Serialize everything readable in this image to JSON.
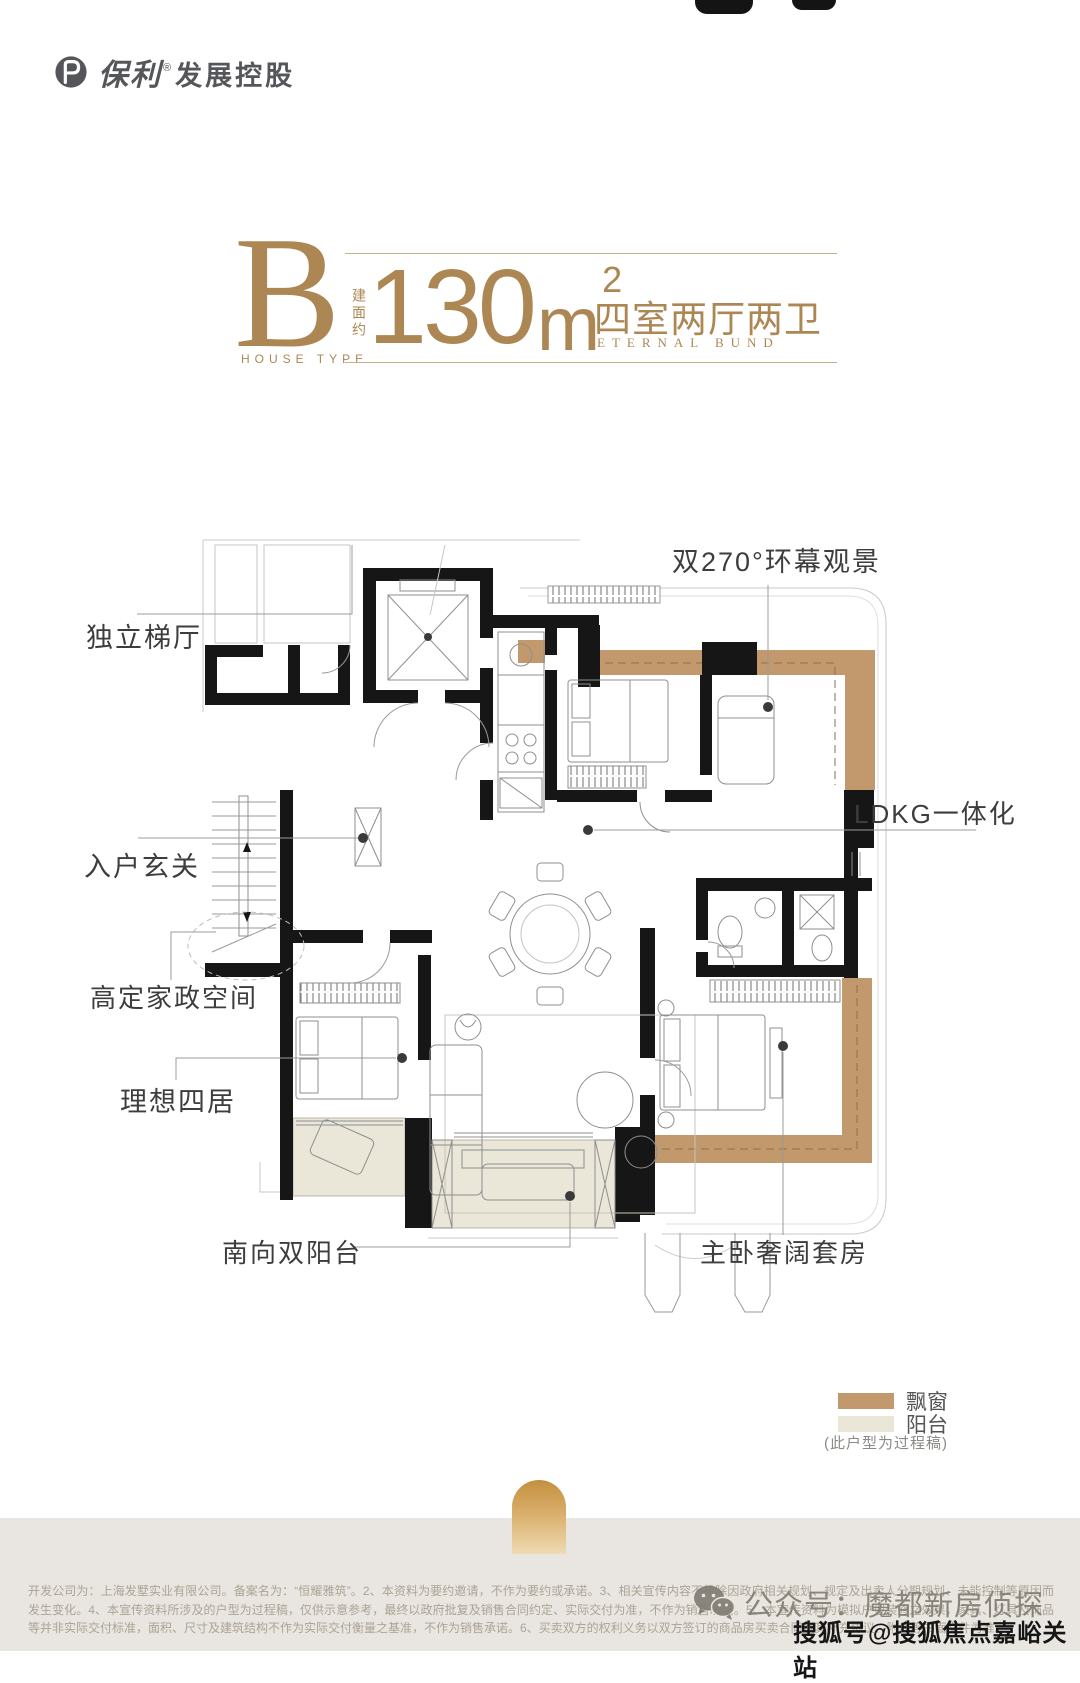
{
  "brand": {
    "name_mark": "保利",
    "registered": "®",
    "name_rest": "发展控股"
  },
  "title": {
    "letter": "B",
    "letter_caption": "HOUSE TYPE",
    "area_prefix": "建面约",
    "area_number": "130",
    "area_unit": "m",
    "area_exponent": "2",
    "rooms": "四室两厅两卫",
    "rooms_en": "ETERNAL BUND"
  },
  "plan": {
    "labels": {
      "lift_lobby": "独立梯厅",
      "entry": "入户玄关",
      "view": "双270°环幕观景",
      "ldkg": "LDKG一体化",
      "housework": "高定家政空间",
      "ideal_rooms": "理想四居",
      "south_balcony": "南向双阳台",
      "master_suite": "主卧奢阔套房"
    }
  },
  "legend": {
    "bay_window_label": "飘窗",
    "balcony_label": "阳台",
    "note": "(此户型为过程稿)",
    "bay_window_color": "#c2996c",
    "balcony_color": "#eae6d8"
  },
  "footer": {
    "disclaimer": "开发公司为：上海发墅实业有限公司。备案名为：“恒耀雅筑”。2、本资料为要约邀请，不作为要约或承诺。3、相关宣传内容不排除因政府相关规划、规定及出卖人分期规划、未能控制等原因而发生变化。4、本宣传资料所涉及的户型为过程稿，仅供示意参考，最终以政府批复及销售合同约定、实际交付为准，不作为销售承诺。5、本宣传资料为模拟户型装修之效果，家具、灯具及饰品等并非实际交付标准，面积、尺寸及建筑结构不作为实际交付衡量之基准，不作为销售承诺。6、买卖双方的权利义务以双方签订的商品房买卖合同及其补充协议、附件等书面文件为准。",
    "wechat_watermark": "公众号：魔都新房侦探",
    "sohu_watermark": "搜狐号@搜狐焦点嘉峪关站"
  },
  "colors": {
    "accent_gold": "#ad8753",
    "wall": "#161616",
    "bay_window": "#c2996c",
    "balcony": "#eae6d8",
    "footer_band": "#e9e6e1"
  }
}
